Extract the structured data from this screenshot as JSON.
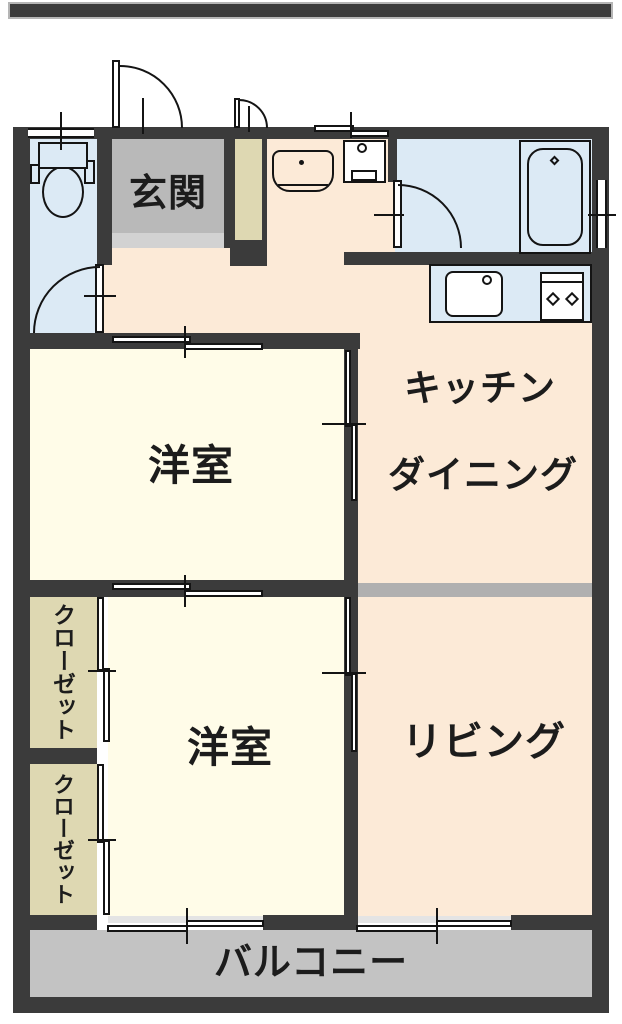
{
  "title": "2LDK apartment floor plan",
  "palette": {
    "wall": "#3b3b3b",
    "line": "#141414",
    "peach": "#fcead7",
    "cream": "#fffce8",
    "tan": "#ded8b2",
    "blue": "#dceaf5",
    "genkan": "#b9b9b9",
    "step": "#d2d2d2",
    "balcony": "#c3c3c3",
    "divider": "#b0b0b0",
    "sill": "#e4e4e4"
  },
  "rooms": {
    "genkan": {
      "label": "玄関"
    },
    "kitchen_dining": {
      "label1": "キッチン",
      "label2": "ダイニング"
    },
    "bedroom1": {
      "label": "洋室"
    },
    "bedroom2": {
      "label": "洋室"
    },
    "living": {
      "label": "リビング"
    },
    "closet1": {
      "label": "クローゼット"
    },
    "closet2": {
      "label": "クローゼット"
    },
    "balcony": {
      "label": "バルコニー"
    },
    "toilet": {
      "label": ""
    },
    "bathroom": {
      "label": ""
    },
    "washroom": {
      "label": ""
    }
  },
  "fixtures": [
    "toilet",
    "washbasin",
    "washing-machine-pan",
    "bathtub",
    "kitchen-sink",
    "gas-stove"
  ]
}
